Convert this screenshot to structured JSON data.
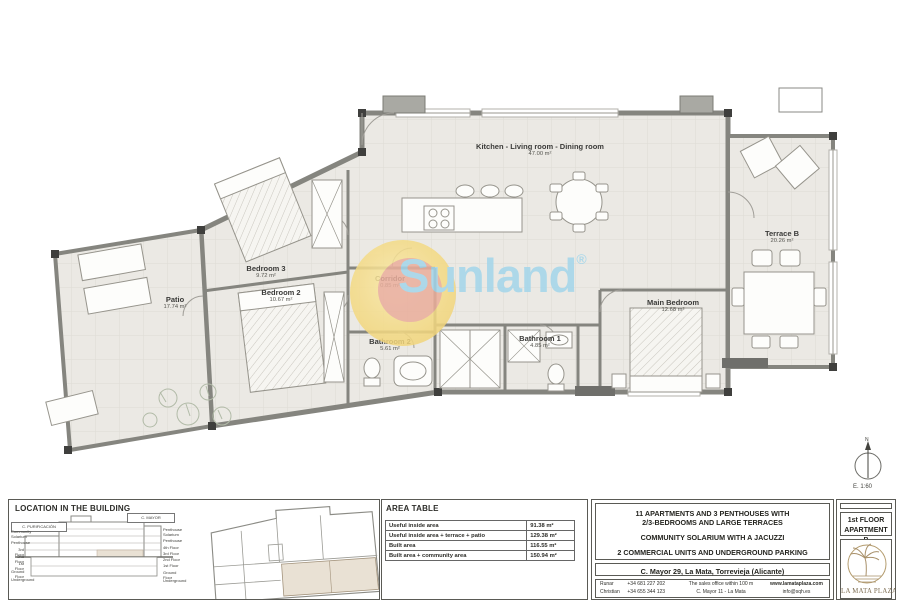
{
  "plan": {
    "watermark_text": "Sunland",
    "watermark_reg": "®",
    "north_label": "N",
    "scale_label": "E. 1:60",
    "rooms": [
      {
        "name": "Kitchen - Living room - Dining room",
        "area": "47.00 m²"
      },
      {
        "name": "Bedroom 3",
        "area": "9.72 m²"
      },
      {
        "name": "Bedroom 2",
        "area": "10.67 m²"
      },
      {
        "name": "Corridor",
        "area": "0.85 m²"
      },
      {
        "name": "Bathroom 2",
        "area": "5.61 m²"
      },
      {
        "name": "Bathroom 1",
        "area": "4.85 m²"
      },
      {
        "name": "Main Bedroom",
        "area": "12.68 m²"
      },
      {
        "name": "Patio",
        "area": "17.74 m²"
      },
      {
        "name": "Terrace B",
        "area": "20.26 m²"
      }
    ]
  },
  "title_block": {
    "location": {
      "heading": "LOCATION IN THE BUILDING",
      "left_street": "C. PURIFICACIÓN",
      "right_street": "C. MAYOR",
      "left_floors": [
        "Community Solarium",
        "Penthouse",
        "3rd Floor",
        "2nd Floor",
        "1st Floor",
        "Ground Floor",
        "Underground"
      ],
      "right_floors": [
        "Penthouse Solarium",
        "Penthouse",
        "4th Floor",
        "3rd Floor",
        "2nd Floor",
        "1st Floor",
        "Ground Floor",
        "Underground"
      ]
    },
    "area_table": {
      "heading": "AREA TABLE",
      "rows": [
        {
          "label": "Useful inside area",
          "value": "91.38 m²"
        },
        {
          "label": "Useful inside area + terrace + patio",
          "value": "129.38 m²"
        },
        {
          "label": "Built area",
          "value": "116.55 m²"
        },
        {
          "label": "Built area + community area",
          "value": "150.94 m²"
        }
      ]
    },
    "project": {
      "line1": "11 APARTMENTS AND 3 PENTHOUSES WITH",
      "line2": "2/3-BEDROOMS AND LARGE TERRACES",
      "line3": "COMMUNITY SOLARIUM WITH A JACUZZI",
      "line4": "2 COMMERCIAL UNITS AND UNDERGROUND PARKING",
      "address": "C. Mayor 29, La Mata, Torrevieja (Alicante)",
      "contacts": [
        {
          "name": "Runar",
          "phone": "+34 681 227 202"
        },
        {
          "name": "Christian",
          "phone": "+34 655 344 123"
        }
      ],
      "sales_office_line1": "The sales office within 100 m",
      "sales_office_line2": "C. Mayor 11 - La Mata",
      "web": "www.lamataplaza.com",
      "email": "info@sqh.es"
    },
    "sheet": {
      "floor": "1st FLOOR",
      "apartment": "APARTMENT B",
      "brand": "LA MATA PLAZA"
    }
  },
  "colors": {
    "highlight_beige": "#e9e1d4",
    "watermark_yellow": "#f2d77e",
    "watermark_salmon": "#e9a89c",
    "watermark_blue": "#a3d6eb",
    "logo_gold": "#a8906a"
  }
}
